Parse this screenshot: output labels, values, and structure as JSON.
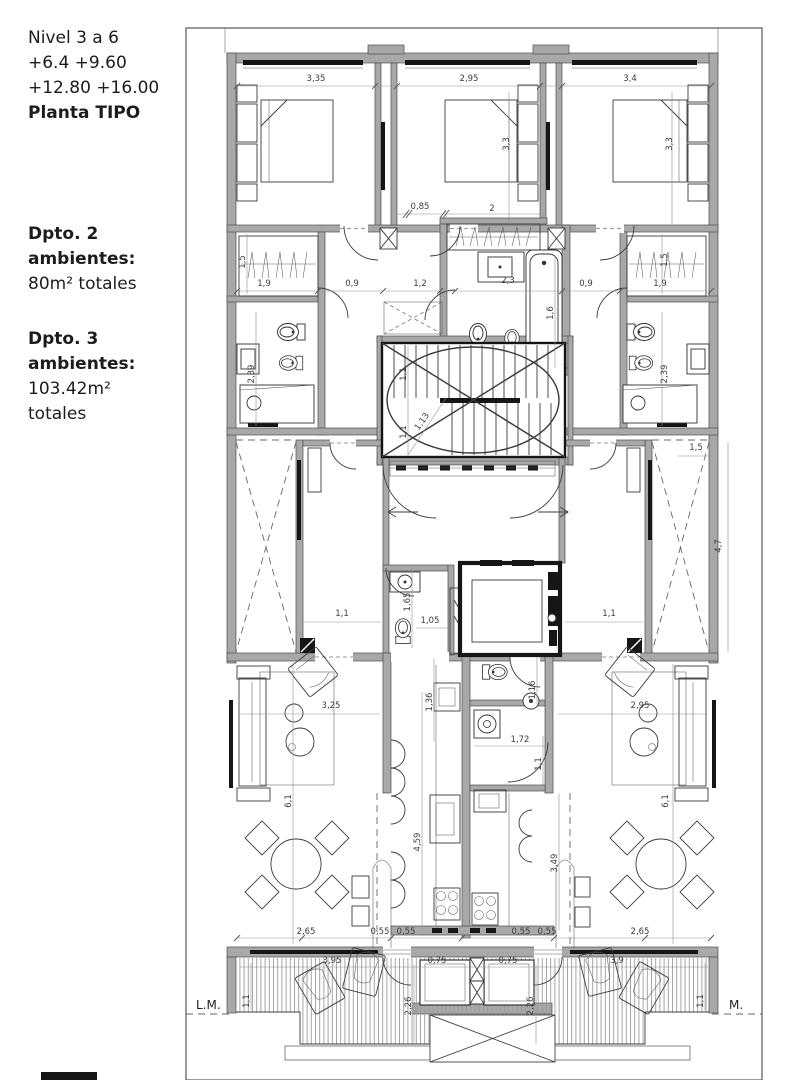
{
  "sidebar": {
    "level_lines": [
      "Nivel 3 a 6",
      "+6.4 +9.60",
      "+12.80 +16.00"
    ],
    "plan_title": "Planta TIPO",
    "apartments": [
      {
        "name": "Dpto. 2",
        "name_line2": "ambientes:",
        "area_line1": "80m² totales",
        "area_line2": ""
      },
      {
        "name": "Dpto. 3",
        "name_line2": "ambientes:",
        "area_line1": "103.42m²",
        "area_line2": "totales"
      }
    ]
  },
  "plan": {
    "boundary_left_label": "L.M.",
    "boundary_right_label": "M.",
    "dim_labels": [
      {
        "t": "3,35",
        "x": 316,
        "y": 81
      },
      {
        "t": "2,95",
        "x": 469,
        "y": 81
      },
      {
        "t": "3,4",
        "x": 630,
        "y": 81
      },
      {
        "t": "3,3",
        "x": 509,
        "y": 144,
        "r": -90
      },
      {
        "t": "3,3",
        "x": 672,
        "y": 144,
        "r": -90
      },
      {
        "t": "0,85",
        "x": 420,
        "y": 209
      },
      {
        "t": "2",
        "x": 492,
        "y": 211
      },
      {
        "t": "1,5",
        "x": 245,
        "y": 262,
        "r": -90
      },
      {
        "t": "1,5",
        "x": 667,
        "y": 260,
        "r": -90
      },
      {
        "t": "1,9",
        "x": 264,
        "y": 286
      },
      {
        "t": "0,9",
        "x": 352,
        "y": 286
      },
      {
        "t": "1,2",
        "x": 420,
        "y": 286
      },
      {
        "t": "2,3",
        "x": 508,
        "y": 283
      },
      {
        "t": "0,9",
        "x": 586,
        "y": 286
      },
      {
        "t": "1,9",
        "x": 660,
        "y": 286
      },
      {
        "t": "2,39",
        "x": 254,
        "y": 374,
        "r": -90
      },
      {
        "t": "2,39",
        "x": 667,
        "y": 374,
        "r": -90
      },
      {
        "t": "1,6",
        "x": 553,
        "y": 313,
        "r": -90
      },
      {
        "t": "1,1",
        "x": 406,
        "y": 374,
        "r": -90
      },
      {
        "t": "1,1",
        "x": 406,
        "y": 432,
        "r": -90
      },
      {
        "t": "1,13",
        "x": 424,
        "y": 423,
        "r": -55
      },
      {
        "t": "1,5",
        "x": 696,
        "y": 450
      },
      {
        "t": "4,7",
        "x": 721,
        "y": 546,
        "r": -90
      },
      {
        "t": "1,1",
        "x": 342,
        "y": 616
      },
      {
        "t": "1,65",
        "x": 410,
        "y": 602,
        "r": -90
      },
      {
        "t": "1,05",
        "x": 430,
        "y": 623
      },
      {
        "t": "1,1",
        "x": 609,
        "y": 616
      },
      {
        "t": "1,36",
        "x": 432,
        "y": 702,
        "r": -90
      },
      {
        "t": "3,25",
        "x": 331,
        "y": 708
      },
      {
        "t": "2,95",
        "x": 640,
        "y": 708
      },
      {
        "t": "1,16",
        "x": 535,
        "y": 690,
        "r": -90
      },
      {
        "t": "1,72",
        "x": 520,
        "y": 742
      },
      {
        "t": "1,1",
        "x": 541,
        "y": 764,
        "r": -90
      },
      {
        "t": "6,1",
        "x": 291,
        "y": 801,
        "r": -90
      },
      {
        "t": "6,1",
        "x": 668,
        "y": 801,
        "r": -90
      },
      {
        "t": "4,59",
        "x": 420,
        "y": 842,
        "r": -90
      },
      {
        "t": "3,49",
        "x": 557,
        "y": 863,
        "r": -90
      },
      {
        "t": "2,65",
        "x": 306,
        "y": 934
      },
      {
        "t": "0,55",
        "x": 380,
        "y": 934
      },
      {
        "t": "0,55",
        "x": 406,
        "y": 934
      },
      {
        "t": "0,55",
        "x": 521,
        "y": 934
      },
      {
        "t": "0,55",
        "x": 547,
        "y": 934
      },
      {
        "t": "2,65",
        "x": 640,
        "y": 934
      },
      {
        "t": "3,95",
        "x": 332,
        "y": 963
      },
      {
        "t": "0,75",
        "x": 437,
        "y": 963
      },
      {
        "t": "0,75",
        "x": 508,
        "y": 963
      },
      {
        "t": "3,9",
        "x": 617,
        "y": 963
      },
      {
        "t": "1,1",
        "x": 249,
        "y": 1001,
        "r": -90
      },
      {
        "t": "1,1",
        "x": 703,
        "y": 1001,
        "r": -90
      },
      {
        "t": "2,26",
        "x": 411,
        "y": 1006,
        "r": -90
      },
      {
        "t": "2,26",
        "x": 533,
        "y": 1006,
        "r": -90
      }
    ]
  },
  "colors": {
    "wall_fill": "#a8a8a8",
    "wall_edge": "#4f4f4f",
    "dark": "#161616",
    "line": "#3a3a3a",
    "dim_text": "#3d3d3d",
    "stripe": "#9b9b9b"
  }
}
